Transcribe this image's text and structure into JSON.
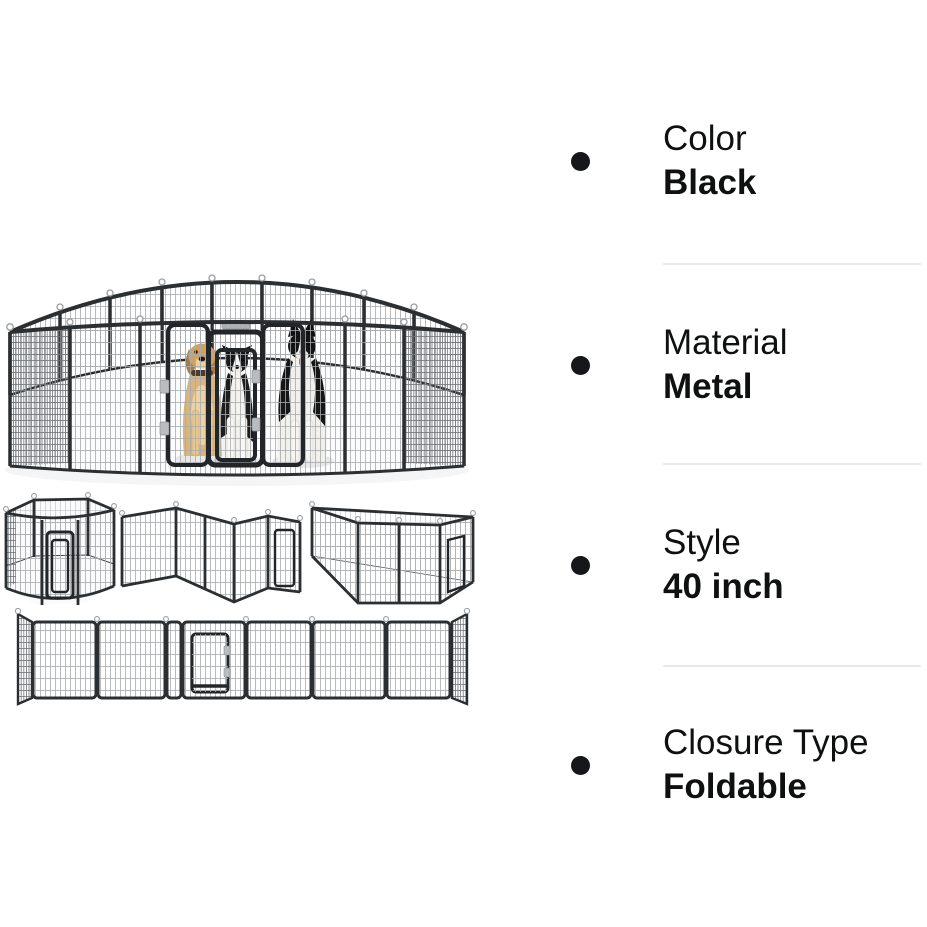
{
  "page": {
    "background": "#ffffff",
    "kind": "product detail facts panel with product image"
  },
  "product_facts": {
    "text_color": "#0f1111",
    "divider_color": "#e8e8e8",
    "bullet_color": "#16171a",
    "items": [
      {
        "label": "Color",
        "value": "Black"
      },
      {
        "label": "Material",
        "value": "Metal"
      },
      {
        "label": "Style",
        "value": "40 inch"
      },
      {
        "label": "Closure Type",
        "value": "Foldable"
      }
    ]
  },
  "product_image": {
    "description": "Black foldable metal dog playpen, 16 panels",
    "frame_color": "#2c2f31",
    "mesh_color": "#a7abae",
    "views": [
      {
        "name": "assembled-circle-pen-with-three-dogs"
      },
      {
        "name": "hexagon-configuration"
      },
      {
        "name": "l-shape-configuration"
      },
      {
        "name": "rectangle-configuration"
      },
      {
        "name": "unfolded-flat-panels"
      }
    ]
  }
}
